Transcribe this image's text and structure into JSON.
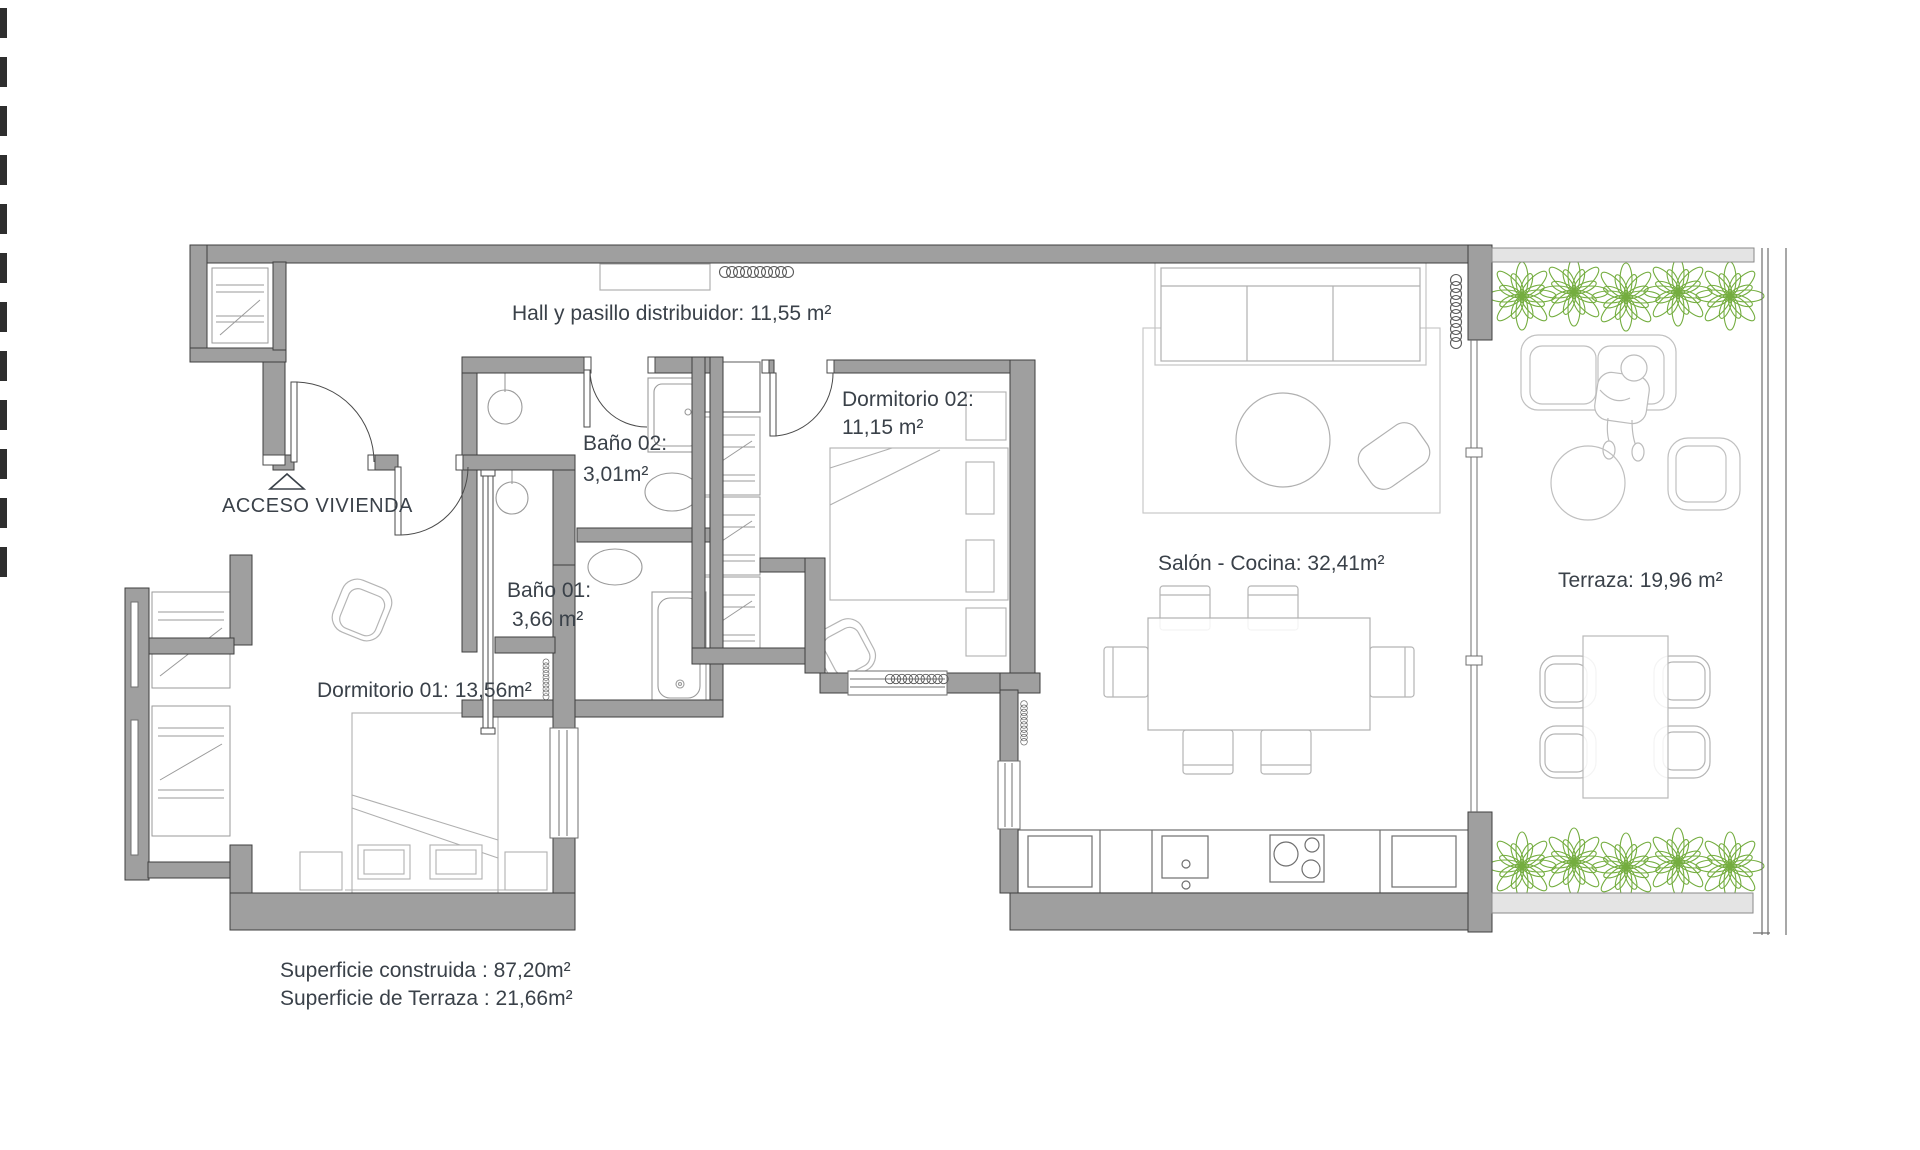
{
  "plan": {
    "type": "apartment-floor-plan",
    "rooms": {
      "hall": {
        "label": "Hall y pasillo distribuidor: 11,55 m²"
      },
      "acceso": {
        "label": "ACCESO VIVIENDA"
      },
      "bano02": {
        "name": "Baño 02:",
        "area": "3,01m²"
      },
      "bano01": {
        "name": "Baño 01:",
        "area": "3,66 m²"
      },
      "dorm02": {
        "name": "Dormitorio 02:",
        "area": "11,15 m²"
      },
      "dorm01": {
        "label": "Dormitorio 01: 13,56m²"
      },
      "salon": {
        "label": "Salón - Cocina: 32,41m²"
      },
      "terraza": {
        "label": "Terraza: 19,96 m²"
      }
    },
    "summary": {
      "line1": "Superficie construida : 87,20m²",
      "line2": "Superficie de Terraza : 21,66m²"
    },
    "colors": {
      "wall": "#9f9f9f",
      "wall_outline": "#3f3f3f",
      "light_wall": "#e4e4e4",
      "furniture": "#b0b0b0",
      "fixture": "#9a9a9a",
      "plant": "#74ad3f",
      "text": "#3a4149"
    }
  }
}
